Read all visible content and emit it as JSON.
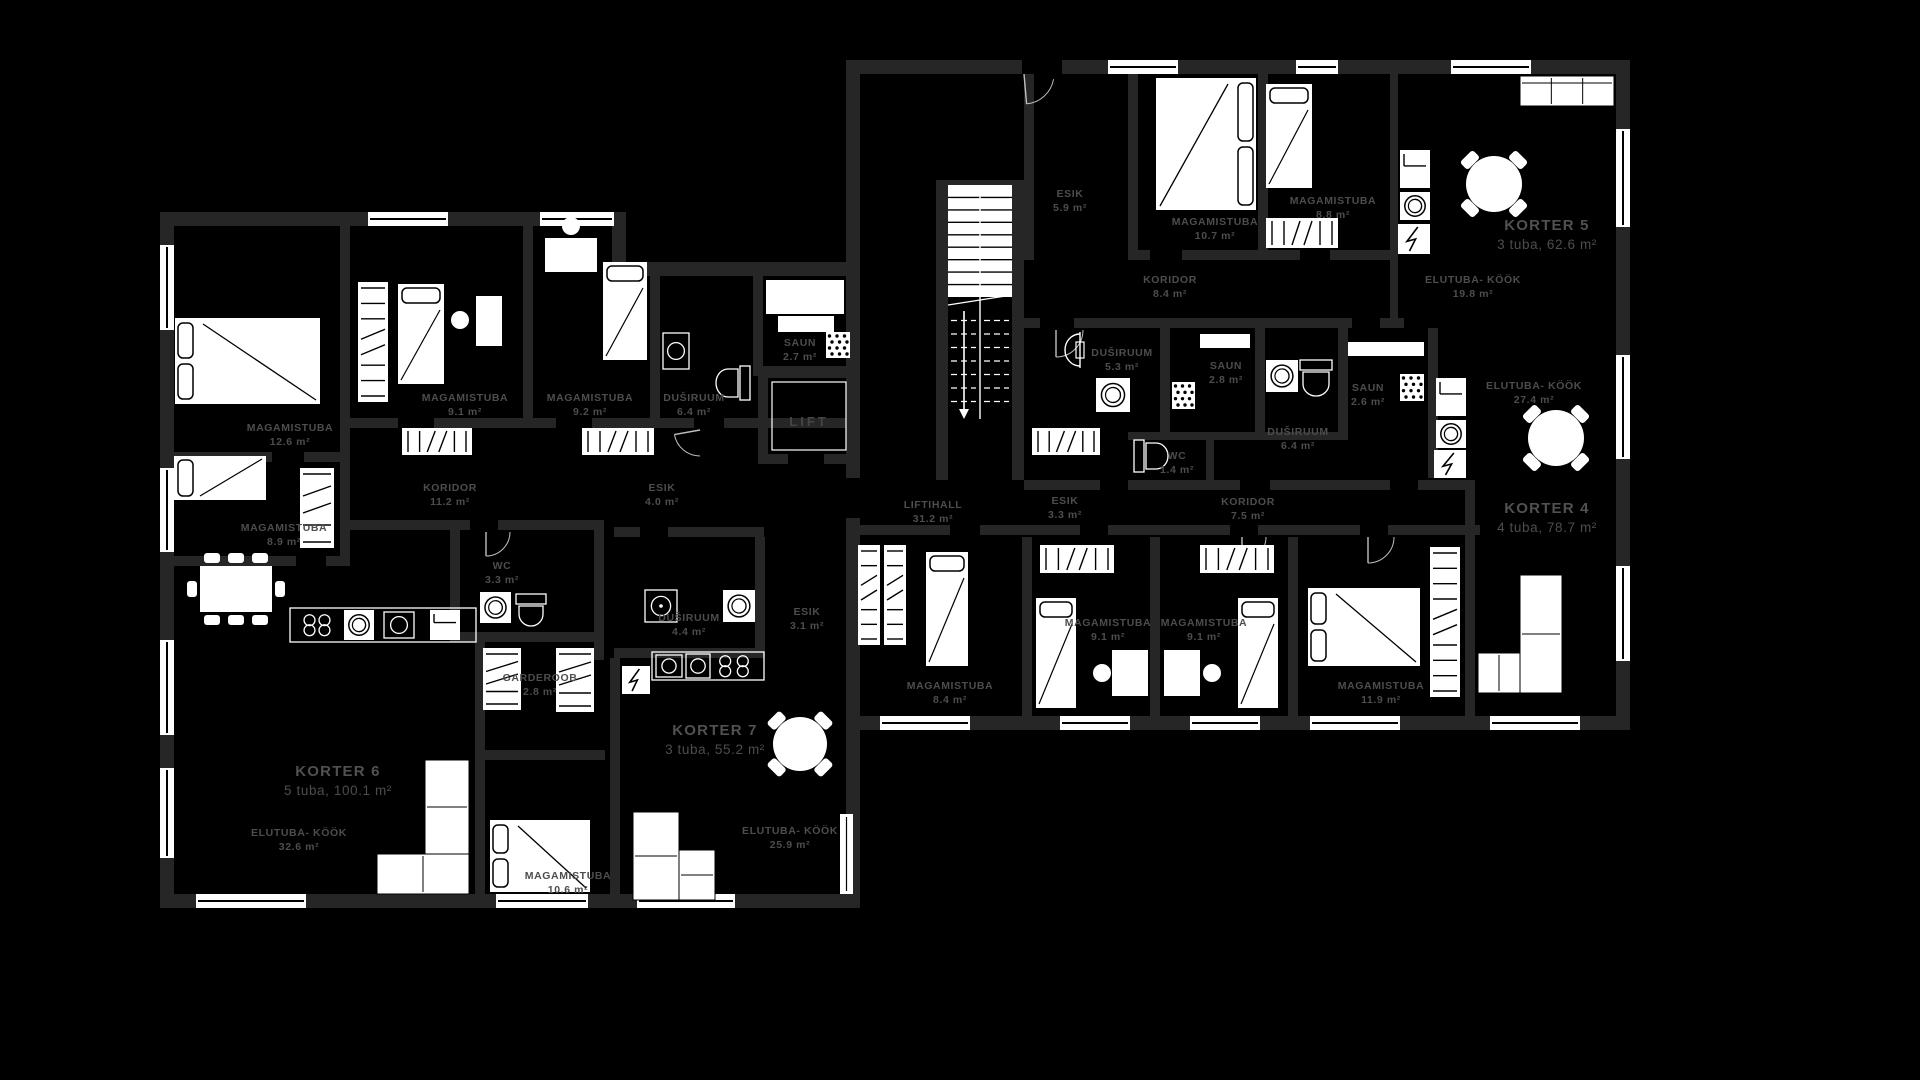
{
  "meta": {
    "background": "#000000",
    "wall_color": "#262626",
    "furniture_color": "#ffffff",
    "label_color": "#4d4d4d",
    "title_color": "#515151"
  },
  "labels": {
    "lift": "LIFT"
  },
  "apartments": [
    {
      "name": "KORTER 5",
      "info": "3 tuba, 62.6 m²",
      "x": 1547,
      "y": 230
    },
    {
      "name": "KORTER 4",
      "info": "4 tuba, 78.7 m²",
      "x": 1547,
      "y": 513
    },
    {
      "name": "KORTER 6",
      "info": "5 tuba, 100.1 m²",
      "x": 338,
      "y": 776
    },
    {
      "name": "KORTER 7",
      "info": "3 tuba, 55.2 m²",
      "x": 715,
      "y": 735
    }
  ],
  "rooms": [
    {
      "name": "MAGAMISTUBA",
      "area": "12.6 m²",
      "x": 290,
      "y": 431
    },
    {
      "name": "MAGAMISTUBA",
      "area": "9.1 m²",
      "x": 465,
      "y": 401
    },
    {
      "name": "MAGAMISTUBA",
      "area": "9.2 m²",
      "x": 590,
      "y": 401
    },
    {
      "name": "DUŠIRUUM",
      "area": "6.4 m²",
      "x": 694,
      "y": 401
    },
    {
      "name": "KORIDOR",
      "area": "11.2 m²",
      "x": 450,
      "y": 491
    },
    {
      "name": "ESIK",
      "area": "4.0 m²",
      "x": 662,
      "y": 491
    },
    {
      "name": "SAUN",
      "area": "2.7 m²",
      "x": 800,
      "y": 346
    },
    {
      "name": "MAGAMISTUBA",
      "area": "8.9 m²",
      "x": 284,
      "y": 531
    },
    {
      "name": "WC",
      "area": "3.3 m²",
      "x": 502,
      "y": 569
    },
    {
      "name": "ELUTUBA- KÖÖK",
      "area": "32.6 m²",
      "x": 299,
      "y": 836
    },
    {
      "name": "GARDEROOB",
      "area": "2.8 m²",
      "x": 540,
      "y": 681
    },
    {
      "name": "DUŠIRUUM",
      "area": "4.4 m²",
      "x": 689,
      "y": 621
    },
    {
      "name": "MAGAMISTUBA",
      "area": "10.6 m²",
      "x": 568,
      "y": 879
    },
    {
      "name": "ELUTUBA- KÖÖK",
      "area": "25.9 m²",
      "x": 790,
      "y": 834
    },
    {
      "name": "ESIK",
      "area": "3.1 m²",
      "x": 807,
      "y": 615
    },
    {
      "name": "LIFTIHALL",
      "area": "31.2 m²",
      "x": 933,
      "y": 508
    },
    {
      "name": "ESIK",
      "area": "5.9 m²",
      "x": 1070,
      "y": 197
    },
    {
      "name": "MAGAMISTUBA",
      "area": "10.7 m²",
      "x": 1215,
      "y": 225
    },
    {
      "name": "MAGAMISTUBA",
      "area": "8.8 m²",
      "x": 1333,
      "y": 204
    },
    {
      "name": "KORIDOR",
      "area": "8.4 m²",
      "x": 1170,
      "y": 283
    },
    {
      "name": "ELUTUBA- KÖÖK",
      "area": "19.8 m²",
      "x": 1473,
      "y": 283
    },
    {
      "name": "DUŠIRUUM",
      "area": "5.3 m²",
      "x": 1122,
      "y": 356
    },
    {
      "name": "SAUN",
      "area": "2.8 m²",
      "x": 1226,
      "y": 369
    },
    {
      "name": "SAUN",
      "area": "2.6 m²",
      "x": 1368,
      "y": 391
    },
    {
      "name": "DUŠIRUUM",
      "area": "6.4 m²",
      "x": 1298,
      "y": 435
    },
    {
      "name": "WC",
      "area": "1.4 m²",
      "x": 1177,
      "y": 459
    },
    {
      "name": "ESIK",
      "area": "3.3 m²",
      "x": 1065,
      "y": 504
    },
    {
      "name": "KORIDOR",
      "area": "7.5 m²",
      "x": 1248,
      "y": 505
    },
    {
      "name": "ELUTUBA- KÖÖK",
      "area": "27.4 m²",
      "x": 1534,
      "y": 389
    },
    {
      "name": "MAGAMISTUBA",
      "area": "8.4 m²",
      "x": 950,
      "y": 689
    },
    {
      "name": "MAGAMISTUBA",
      "area": "9.1 m²",
      "x": 1108,
      "y": 626
    },
    {
      "name": "MAGAMISTUBA",
      "area": "9.1 m²",
      "x": 1204,
      "y": 626
    },
    {
      "name": "MAGAMISTUBA",
      "area": "11.9 m²",
      "x": 1381,
      "y": 689
    }
  ],
  "furniture": [
    {
      "kind": "bed-double",
      "name": "double-bed-icon",
      "x": 175,
      "y": 318,
      "w": 145,
      "h": 86,
      "pillow": "left"
    },
    {
      "kind": "wardrobe",
      "name": "wardrobe-icon",
      "x": 358,
      "y": 282,
      "w": 30,
      "h": 120,
      "dir": "v"
    },
    {
      "kind": "bed-single",
      "name": "single-bed-icon",
      "x": 398,
      "y": 284,
      "w": 46,
      "h": 100,
      "pillow": "top"
    },
    {
      "kind": "desk",
      "name": "desk-icon",
      "x": 476,
      "y": 296,
      "w": 26,
      "h": 50
    },
    {
      "kind": "chair",
      "name": "chair-icon",
      "x": 460,
      "y": 320,
      "r": 9
    },
    {
      "kind": "dresser",
      "name": "dresser-icon",
      "x": 402,
      "y": 428,
      "w": 70,
      "h": 27
    },
    {
      "kind": "dresser",
      "name": "dresser-icon",
      "x": 582,
      "y": 428,
      "w": 72,
      "h": 27
    },
    {
      "kind": "desk",
      "name": "desk-icon",
      "x": 545,
      "y": 238,
      "w": 52,
      "h": 34
    },
    {
      "kind": "chair",
      "name": "chair-icon",
      "x": 571,
      "y": 226,
      "r": 9
    },
    {
      "kind": "bed-single",
      "name": "single-bed-icon",
      "x": 603,
      "y": 262,
      "w": 44,
      "h": 98,
      "pillow": "top"
    },
    {
      "kind": "sink",
      "name": "sink-icon",
      "x": 663,
      "y": 333,
      "w": 26,
      "h": 36
    },
    {
      "kind": "toilet",
      "name": "toilet-icon",
      "x": 714,
      "y": 366,
      "w": 36,
      "h": 34,
      "dir": "left"
    },
    {
      "kind": "bench",
      "name": "sauna-bench-icon",
      "x": 766,
      "y": 280,
      "w": 78,
      "h": 34
    },
    {
      "kind": "bench",
      "name": "sauna-bench-icon",
      "x": 778,
      "y": 316,
      "w": 56,
      "h": 16
    },
    {
      "kind": "heater",
      "name": "sauna-heater-icon",
      "x": 826,
      "y": 332,
      "w": 24,
      "h": 26
    },
    {
      "kind": "bed-single",
      "name": "single-bed-icon",
      "x": 174,
      "y": 456,
      "w": 92,
      "h": 44,
      "pillow": "left"
    },
    {
      "kind": "wardrobe",
      "name": "wardrobe-icon",
      "x": 300,
      "y": 468,
      "w": 34,
      "h": 80,
      "dir": "v"
    },
    {
      "kind": "table-rect",
      "name": "dining-table-icon",
      "x": 200,
      "y": 566,
      "w": 72,
      "h": 46
    },
    {
      "kind": "counter",
      "name": "kitchen-counter-icon",
      "x": 290,
      "y": 608,
      "w": 186,
      "h": 34
    },
    {
      "kind": "stove",
      "name": "stove-icon",
      "x": 300,
      "y": 613,
      "w": 34,
      "h": 24
    },
    {
      "kind": "washer",
      "name": "washing-machine-icon",
      "x": 344,
      "y": 610,
      "w": 30,
      "h": 30
    },
    {
      "kind": "sink",
      "name": "kitchen-sink-icon",
      "x": 384,
      "y": 612,
      "w": 30,
      "h": 26
    },
    {
      "kind": "fridge",
      "name": "fridge-icon",
      "x": 430,
      "y": 610,
      "w": 30,
      "h": 30
    },
    {
      "kind": "washer",
      "name": "washing-machine-icon",
      "x": 480,
      "y": 592,
      "w": 31,
      "h": 31
    },
    {
      "kind": "toilet",
      "name": "toilet-icon",
      "x": 516,
      "y": 594,
      "w": 30,
      "h": 34,
      "dir": "down"
    },
    {
      "kind": "wardrobe",
      "name": "wardrobe-icon",
      "x": 483,
      "y": 648,
      "w": 38,
      "h": 62,
      "dir": "v"
    },
    {
      "kind": "wardrobe",
      "name": "wardrobe-icon",
      "x": 556,
      "y": 648,
      "w": 38,
      "h": 64,
      "dir": "v"
    },
    {
      "kind": "boiler",
      "name": "boiler-icon",
      "x": 622,
      "y": 666,
      "w": 28,
      "h": 28
    },
    {
      "kind": "counter",
      "name": "kitchen-counter-icon",
      "x": 652,
      "y": 652,
      "w": 112,
      "h": 28
    },
    {
      "kind": "sink",
      "name": "kitchen-sink-icon",
      "x": 656,
      "y": 655,
      "w": 26,
      "h": 22
    },
    {
      "kind": "washer-o",
      "name": "dishwasher-icon",
      "x": 686,
      "y": 654,
      "w": 24,
      "h": 24
    },
    {
      "kind": "stove",
      "name": "stove-icon",
      "x": 714,
      "y": 654,
      "w": 40,
      "h": 24
    },
    {
      "kind": "shower",
      "name": "shower-icon",
      "x": 645,
      "y": 590,
      "w": 32,
      "h": 32
    },
    {
      "kind": "washer",
      "name": "washing-machine-icon",
      "x": 723,
      "y": 590,
      "w": 32,
      "h": 32
    },
    {
      "kind": "bed-double",
      "name": "double-bed-icon",
      "x": 490,
      "y": 820,
      "w": 100,
      "h": 72,
      "pillow": "left"
    },
    {
      "kind": "sofa",
      "name": "corner-sofa-icon",
      "rects": [
        [
          425,
          760,
          44,
          94
        ],
        [
          377,
          854,
          92,
          40
        ]
      ]
    },
    {
      "kind": "sofa",
      "name": "corner-sofa-icon",
      "rects": [
        [
          633,
          812,
          46,
          88
        ],
        [
          679,
          850,
          36,
          50
        ]
      ]
    },
    {
      "kind": "radiator",
      "name": "radiator-icon",
      "x": 840,
      "y": 814,
      "w": 13,
      "h": 80
    },
    {
      "kind": "table-round",
      "name": "round-table-icon",
      "cx": 800,
      "cy": 744,
      "r": 27
    },
    {
      "kind": "dresser",
      "name": "dresser-icon",
      "x": 1032,
      "y": 428,
      "w": 68,
      "h": 27
    },
    {
      "kind": "bed-single",
      "name": "single-bed-icon",
      "x": 926,
      "y": 552,
      "w": 42,
      "h": 114,
      "pillow": "top"
    },
    {
      "kind": "wardrobe",
      "name": "wardrobe-icon",
      "x": 858,
      "y": 545,
      "w": 22,
      "h": 100,
      "dir": "v"
    },
    {
      "kind": "wardrobe",
      "name": "wardrobe-icon",
      "x": 884,
      "y": 545,
      "w": 22,
      "h": 100,
      "dir": "v"
    },
    {
      "kind": "dresser",
      "name": "dresser-icon",
      "x": 1040,
      "y": 545,
      "w": 74,
      "h": 28
    },
    {
      "kind": "bed-single",
      "name": "single-bed-icon",
      "x": 1036,
      "y": 598,
      "w": 40,
      "h": 110,
      "pillow": "top"
    },
    {
      "kind": "desk",
      "name": "desk-icon",
      "x": 1112,
      "y": 650,
      "w": 36,
      "h": 46
    },
    {
      "kind": "desk",
      "name": "desk-icon",
      "x": 1164,
      "y": 650,
      "w": 36,
      "h": 46
    },
    {
      "kind": "chair",
      "name": "chair-icon",
      "x": 1102,
      "y": 673,
      "r": 9
    },
    {
      "kind": "chair",
      "name": "chair-icon",
      "x": 1212,
      "y": 673,
      "r": 9
    },
    {
      "kind": "dresser",
      "name": "dresser-icon",
      "x": 1200,
      "y": 545,
      "w": 74,
      "h": 28
    },
    {
      "kind": "bed-single",
      "name": "single-bed-icon",
      "x": 1238,
      "y": 598,
      "w": 40,
      "h": 110,
      "pillow": "top"
    },
    {
      "kind": "bed-double",
      "name": "double-bed-icon",
      "x": 1308,
      "y": 588,
      "w": 112,
      "h": 78,
      "pillow": "left"
    },
    {
      "kind": "wardrobe",
      "name": "wardrobe-icon",
      "x": 1430,
      "y": 547,
      "w": 30,
      "h": 150,
      "dir": "v"
    },
    {
      "kind": "sofa",
      "name": "corner-sofa-icon",
      "rects": [
        [
          1520,
          575,
          42,
          118
        ],
        [
          1478,
          653,
          42,
          40
        ]
      ]
    },
    {
      "kind": "table-round",
      "name": "round-table-icon",
      "cx": 1556,
      "cy": 438,
      "r": 28
    },
    {
      "kind": "fridge",
      "name": "fridge-icon",
      "x": 1436,
      "y": 378,
      "w": 30,
      "h": 38
    },
    {
      "kind": "washer",
      "name": "washing-machine-icon",
      "x": 1436,
      "y": 420,
      "w": 30,
      "h": 28
    },
    {
      "kind": "boiler",
      "name": "boiler-icon",
      "x": 1434,
      "y": 450,
      "w": 32,
      "h": 28
    },
    {
      "kind": "washer",
      "name": "washing-machine-icon",
      "x": 1266,
      "y": 360,
      "w": 32,
      "h": 32
    },
    {
      "kind": "toilet",
      "name": "toilet-icon",
      "x": 1300,
      "y": 360,
      "w": 32,
      "h": 38,
      "dir": "down"
    },
    {
      "kind": "heater",
      "name": "sauna-heater-icon",
      "x": 1172,
      "y": 382,
      "w": 23,
      "h": 27
    },
    {
      "kind": "heater",
      "name": "sauna-heater-icon",
      "x": 1400,
      "y": 374,
      "w": 24,
      "h": 27
    },
    {
      "kind": "bench",
      "name": "sauna-bench-icon",
      "x": 1200,
      "y": 334,
      "w": 50,
      "h": 14
    },
    {
      "kind": "bench",
      "name": "sauna-bench-icon",
      "x": 1348,
      "y": 342,
      "w": 76,
      "h": 14
    },
    {
      "kind": "washer",
      "name": "washing-machine-icon",
      "x": 1096,
      "y": 378,
      "w": 34,
      "h": 34
    },
    {
      "kind": "shower-head",
      "name": "shower-head-icon",
      "x": 1080,
      "y": 334
    },
    {
      "kind": "toilet",
      "name": "toilet-icon",
      "x": 1134,
      "y": 440,
      "w": 36,
      "h": 32,
      "dir": "right"
    },
    {
      "kind": "bed-double",
      "name": "double-bed-icon",
      "x": 1156,
      "y": 78,
      "w": 100,
      "h": 132,
      "pillow": "right"
    },
    {
      "kind": "bed-single",
      "name": "single-bed-icon",
      "x": 1266,
      "y": 84,
      "w": 46,
      "h": 104,
      "pillow": "top"
    },
    {
      "kind": "dresser",
      "name": "dresser-icon",
      "x": 1266,
      "y": 218,
      "w": 72,
      "h": 30
    },
    {
      "kind": "sofa-straight",
      "name": "sofa-icon",
      "x": 1520,
      "y": 76,
      "w": 94,
      "h": 30
    },
    {
      "kind": "fridge",
      "name": "fridge-icon",
      "x": 1400,
      "y": 150,
      "w": 30,
      "h": 38
    },
    {
      "kind": "washer",
      "name": "washing-machine-icon",
      "x": 1400,
      "y": 192,
      "w": 30,
      "h": 28
    },
    {
      "kind": "boiler",
      "name": "boiler-icon",
      "x": 1398,
      "y": 224,
      "w": 32,
      "h": 30
    },
    {
      "kind": "table-round",
      "name": "round-table-icon",
      "cx": 1494,
      "cy": 184,
      "r": 28
    },
    {
      "kind": "stairs",
      "name": "staircase-icon",
      "x": 948,
      "y": 185,
      "w": 64,
      "h": 234
    }
  ]
}
